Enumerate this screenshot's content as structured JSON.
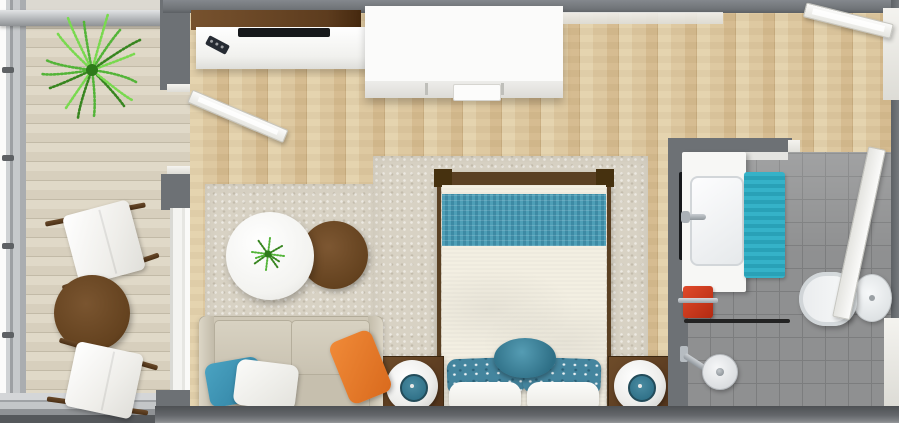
{
  "theme": {
    "wall": "#6d7175",
    "wall_dark": "#595d61",
    "floor_wood": "#dcc49a",
    "rug": "#d8d2c4",
    "tile": "#8f9091",
    "tile_grout": "#7c7d7e",
    "accent_teal": "#35b2c8",
    "teal_band": "#4e9fb7",
    "teal_pillow": "#44859e",
    "teal_dark": "#2e6f86",
    "accent_orange": "#d96a1d",
    "accent_red": "#b32a12",
    "wood_brown": "#64421f",
    "wood_frame": "#5a4023",
    "white_furniture": "#fbfbfa",
    "linen": "#f3efe2",
    "sofa": "#cfc8b7",
    "chrome": "#9aa0a6",
    "tv_black": "#17191c",
    "plant_green": "#53b438",
    "plant_green_light": "#79d94f",
    "plant_green_dark": "#37851f"
  },
  "floorplan": {
    "view": "3d-top-down-render",
    "rooms": [
      {
        "id": "balcony",
        "objects": [
          "railing",
          "potted-fern",
          "lounge-chair",
          "lounge-chair",
          "round-bistro-table"
        ]
      },
      {
        "id": "studio-living-sleeping",
        "objects": [
          "media-console",
          "tv",
          "remote-control",
          "wardrobe",
          "area-rug",
          "double-bed",
          "nightstand-with-lamp",
          "nightstand-with-lamp",
          "loveseat-sofa",
          "throw-pillow-teal",
          "throw-pillow-white",
          "throw-pillow-orange",
          "round-coffee-table-white",
          "round-side-table-wood",
          "table-plant"
        ]
      },
      {
        "id": "bathroom",
        "objects": [
          "vanity-with-sink",
          "mirror",
          "bath-mat-teal",
          "red-towel",
          "shower-head",
          "glass-screen",
          "toilet"
        ]
      },
      {
        "id": "entry",
        "objects": [
          "entry-door"
        ]
      }
    ],
    "doors": [
      "balcony-door",
      "entry-door",
      "bathroom-door"
    ]
  }
}
